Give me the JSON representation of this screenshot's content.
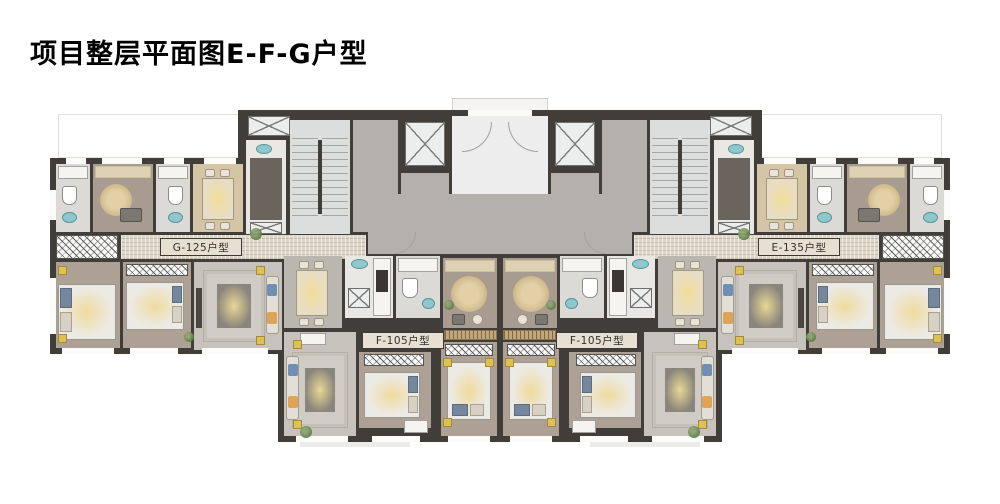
{
  "page": {
    "title": "项目整层平面图E-F-G户型"
  },
  "plan": {
    "unit_labels": {
      "g": "G-125户型",
      "e": "E-135户型",
      "f_left": "F-105户型",
      "f_right": "F-105户型"
    },
    "colors": {
      "wall": "#413e3a",
      "hall_stone": "#ddd5c7",
      "corridor_gray": "#b4b1ac",
      "warm_floor": "#a89c91",
      "dining_tan": "#d3c5a6",
      "rug_glow": "#eedf9c",
      "sink_teal": "#8fc8cc",
      "cushion_blue": "#6f8fb5",
      "cushion_orange": "#dfa356",
      "plant_green": "#6d8c5d"
    }
  }
}
